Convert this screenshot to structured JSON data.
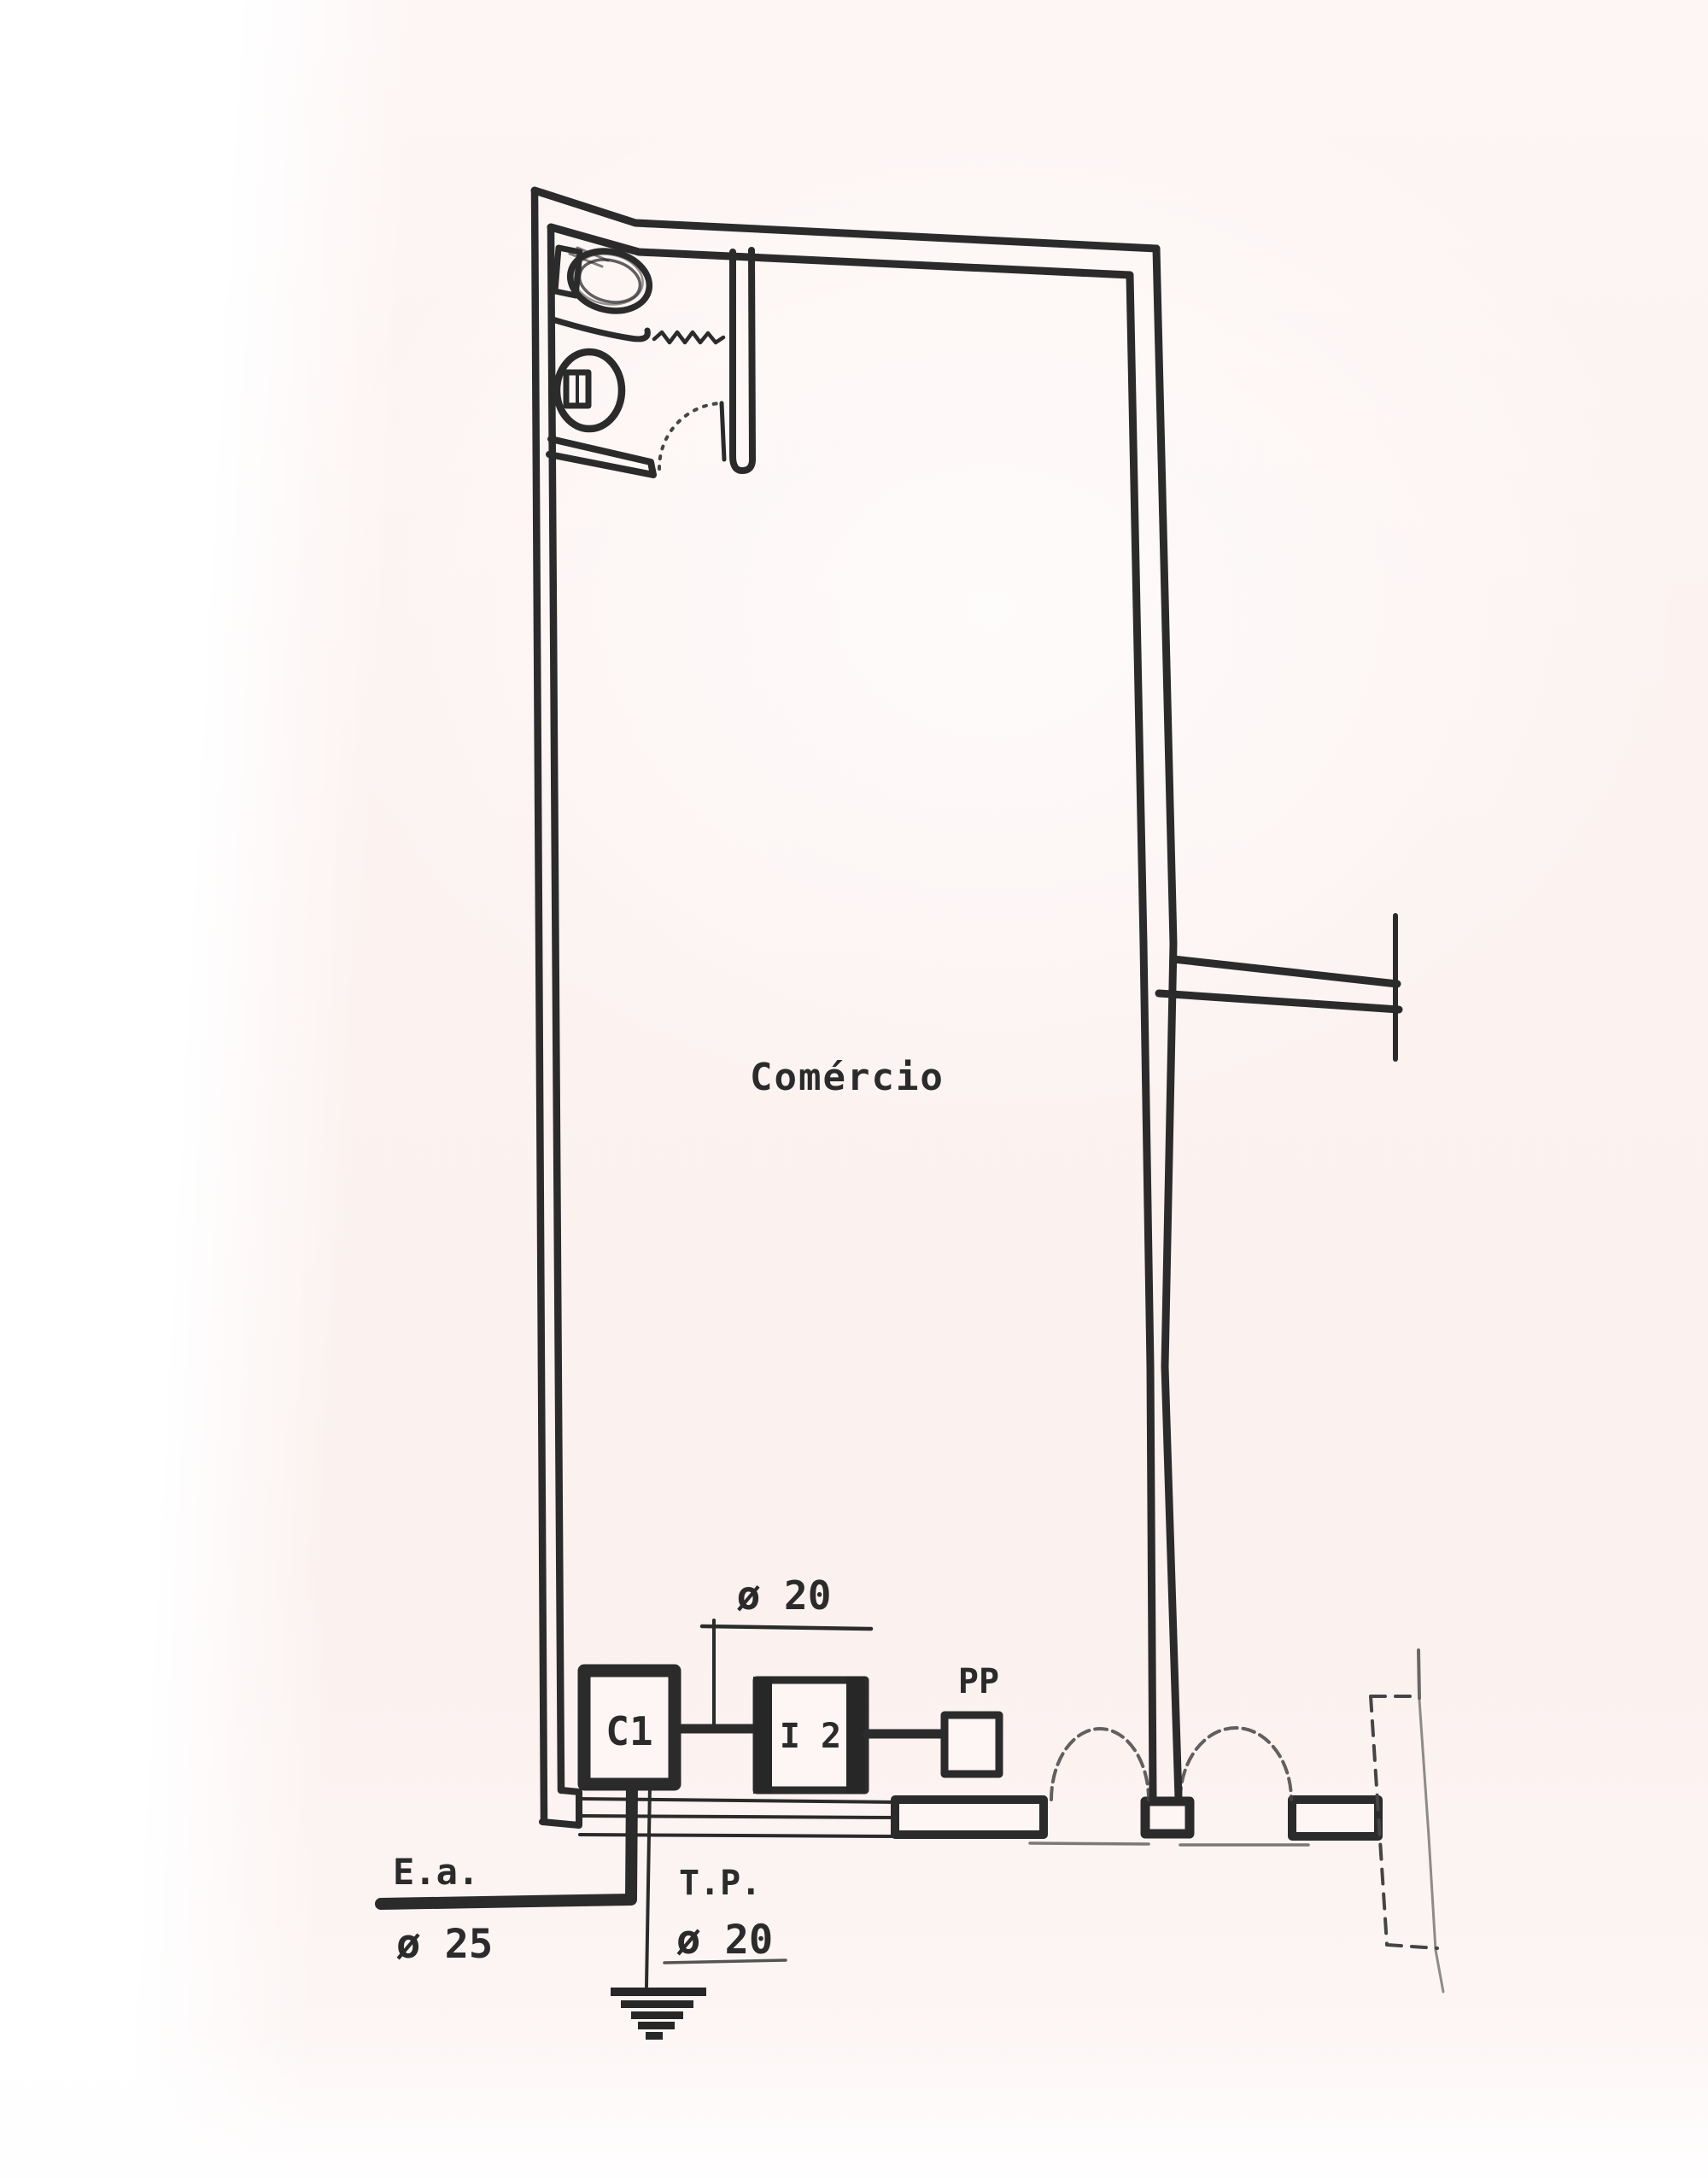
{
  "page": {
    "background_tint": "#fcf3f1",
    "margin_color": "#ffffff",
    "ink_color": "#2b2b2b"
  },
  "plan": {
    "room": {
      "label": "Comércio"
    },
    "bathroom": {
      "fixture_icons": [
        "sink-icon",
        "toilet-icon",
        "shower-zigzag-icon",
        "door-swing-icon"
      ]
    },
    "storefront": {
      "icons": [
        "display-window-icon",
        "door-swing-icon",
        "door-swing-icon",
        "display-window-icon",
        "projection-dashed-icon"
      ]
    },
    "electrical": {
      "circuit_box_label": "C1",
      "switch_box_label": "I 2",
      "pp_label": "PP",
      "conduit_diameter_label": "ø 20",
      "service_entry": {
        "label": "E.a.",
        "diameter_label": "ø 25"
      },
      "ground": {
        "label": "T.P.",
        "diameter_label": "ø 20",
        "icon": "earth-ground-icon"
      }
    }
  }
}
